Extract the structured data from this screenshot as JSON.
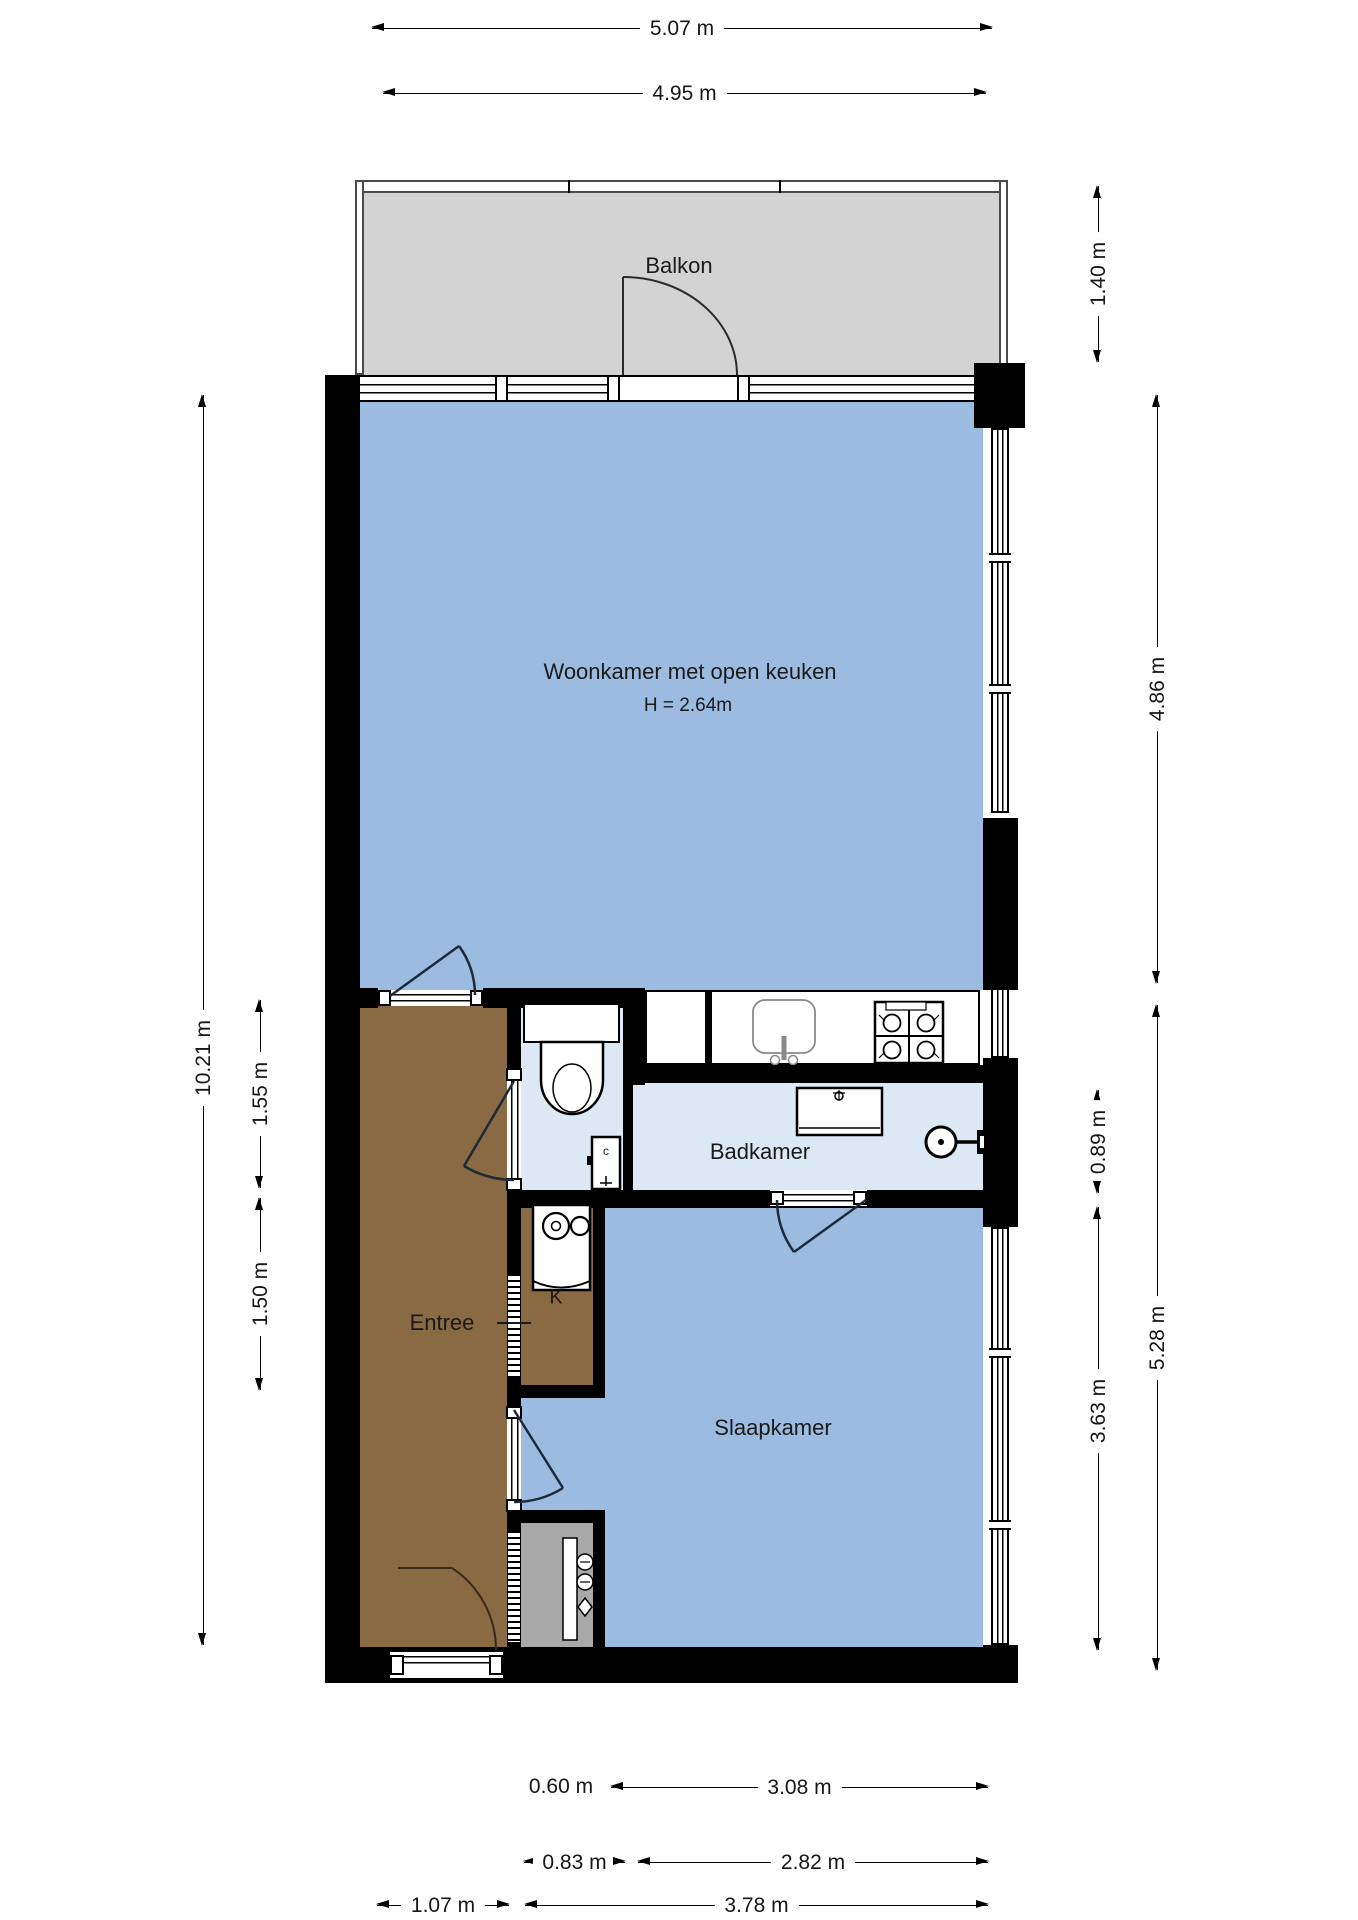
{
  "plan": {
    "rooms": {
      "balcony": {
        "label": "Balkon"
      },
      "living": {
        "label": "Woonkamer met open keuken",
        "height_note": "H = 2.64m"
      },
      "bathroom": {
        "label": "Badkamer"
      },
      "bedroom": {
        "label": "Slaapkamer"
      },
      "hall": {
        "label": "Entree"
      },
      "closet": {
        "label": "K"
      },
      "boiler": {
        "label": "c"
      }
    },
    "dimensions": {
      "top": [
        {
          "label": "5.07 m"
        },
        {
          "label": "4.95 m"
        }
      ],
      "left": [
        {
          "label": "10.21 m"
        },
        {
          "label": "1.55 m"
        },
        {
          "label": "1.50 m"
        }
      ],
      "right": [
        {
          "label": "1.40 m"
        },
        {
          "label": "4.86 m"
        },
        {
          "label": "0.89 m"
        },
        {
          "label": "5.28 m"
        },
        {
          "label": "3.63 m"
        }
      ],
      "bottom": [
        {
          "label": "0.60 m"
        },
        {
          "label": "3.08 m"
        },
        {
          "label": "0.83 m"
        },
        {
          "label": "2.82 m"
        },
        {
          "label": "1.07 m"
        },
        {
          "label": "3.78 m"
        }
      ]
    },
    "colors": {
      "room_blue": "#9bbce0",
      "room_light_blue": "#dce8f3",
      "hall_brown": "#8a6a43",
      "balcony_gray": "#d3d3d3",
      "meter_cabinet_gray": "#a9a9a9",
      "wall": "#000000",
      "dim_text": "#1a1a1a"
    }
  }
}
